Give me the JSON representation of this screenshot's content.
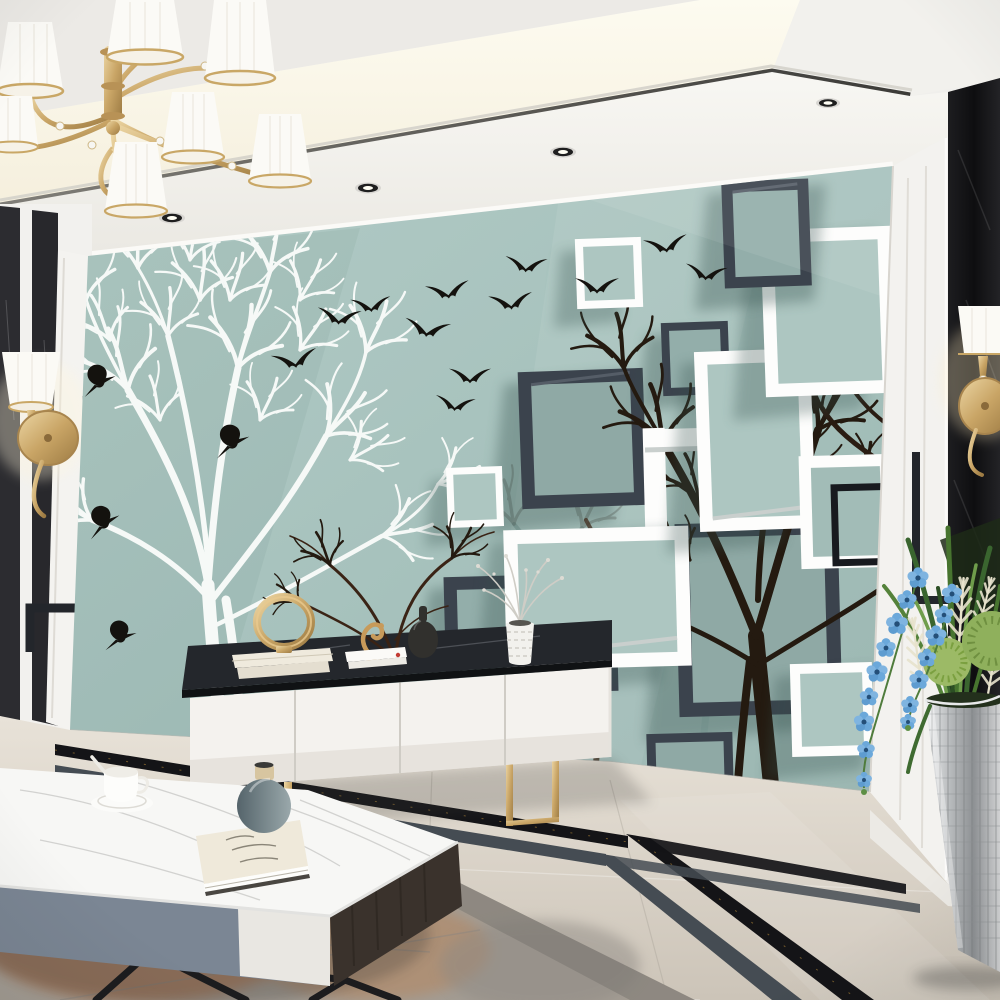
{
  "scene": {
    "title": "Modern living room with 3D teal mural wall of trees, birds and square frames",
    "style": "interior photograph",
    "labels": {
      "ceiling": "white recessed ceiling with warm cove lighting and dark trim",
      "spotlights": "recessed ceiling spotlights",
      "chandelier": "gold chandelier with white pleated shades and crystal drops",
      "left_wall": "side wall with black marble stripes",
      "left_sconce": "gold wall sconce with white shade",
      "right_pilaster": "white fluted pilaster",
      "right_column": "black marble column",
      "right_sconce": "gold wall sconce with white shade",
      "meander": "black geometric wall inlay line",
      "mural": "teal feature wall mural",
      "white_tree": "white bare tree silhouette",
      "dark_tree": "dark bare tree silhouettes",
      "ghost_tree": "faded tree silhouettes",
      "flying_birds": "flock of black birds flying",
      "perched_birds": "black birds perched in white tree",
      "dark_frames": "3D dark grey square frames",
      "white_frames": "3D white square frames",
      "black_frame": "thin black square frame",
      "baseboard": "white baseboard",
      "tv_console": "white TV console with dark marble top and gold legs",
      "console_books": "stack of cream books",
      "gold_ring": "gold ring sculpture",
      "seahorse": "gold seahorse figurine",
      "flat_books": "white books with red bookmark",
      "black_bottle": "black bottle vase",
      "white_vase": "white textured vase with silver dried flowers",
      "dried_branches": "dried brown branch decor",
      "coffee_table": "marble-top coffee table with grey and white drawers and black legs",
      "teacup": "white teacup on saucer with spoon",
      "table_book": "cream book",
      "grey_vase": "grey round vase with beige neck",
      "floor": "beige marble tile floor",
      "floor_inlay": "black marble and grey floor border inlay",
      "rug": "grey and rust distressed rug",
      "plant": "potted arrangement with blue orchids, green leaves and cream plumes",
      "pot": "silver mosaic planter"
    },
    "counts": {
      "ceiling_spotlights": 5,
      "chandelier_shades": 7,
      "flying_birds": 12,
      "perched_birds": 4,
      "mural_dark_frames": 6,
      "mural_white_frames": 8,
      "mural_black_frames": 1,
      "console_drawers": 4,
      "orchid_blossoms": 16
    },
    "palette": {
      "mural_teal": "#a7c2bd",
      "mural_teal_shadow": "#8fa9a5",
      "frame_dark": "#3b434d",
      "frame_white": "#fdfdfc",
      "tree_white": "#f6f9f7",
      "tree_dark": "#241a10",
      "bird_black": "#14120e",
      "gold": "#c9a566",
      "floor_marble": "#ddd5ca",
      "inlay_black": "#141417",
      "inlay_gray": "#454c53",
      "rug_gray": "#a39c93",
      "rug_rust": "#b06430",
      "console_white": "#f4f2ee",
      "console_top": "#24272c",
      "orchid_blue": "#6ba8da",
      "leaf_green": "#47742f",
      "pot_silver": "#c6c9cb",
      "column_black": "#141416"
    }
  }
}
